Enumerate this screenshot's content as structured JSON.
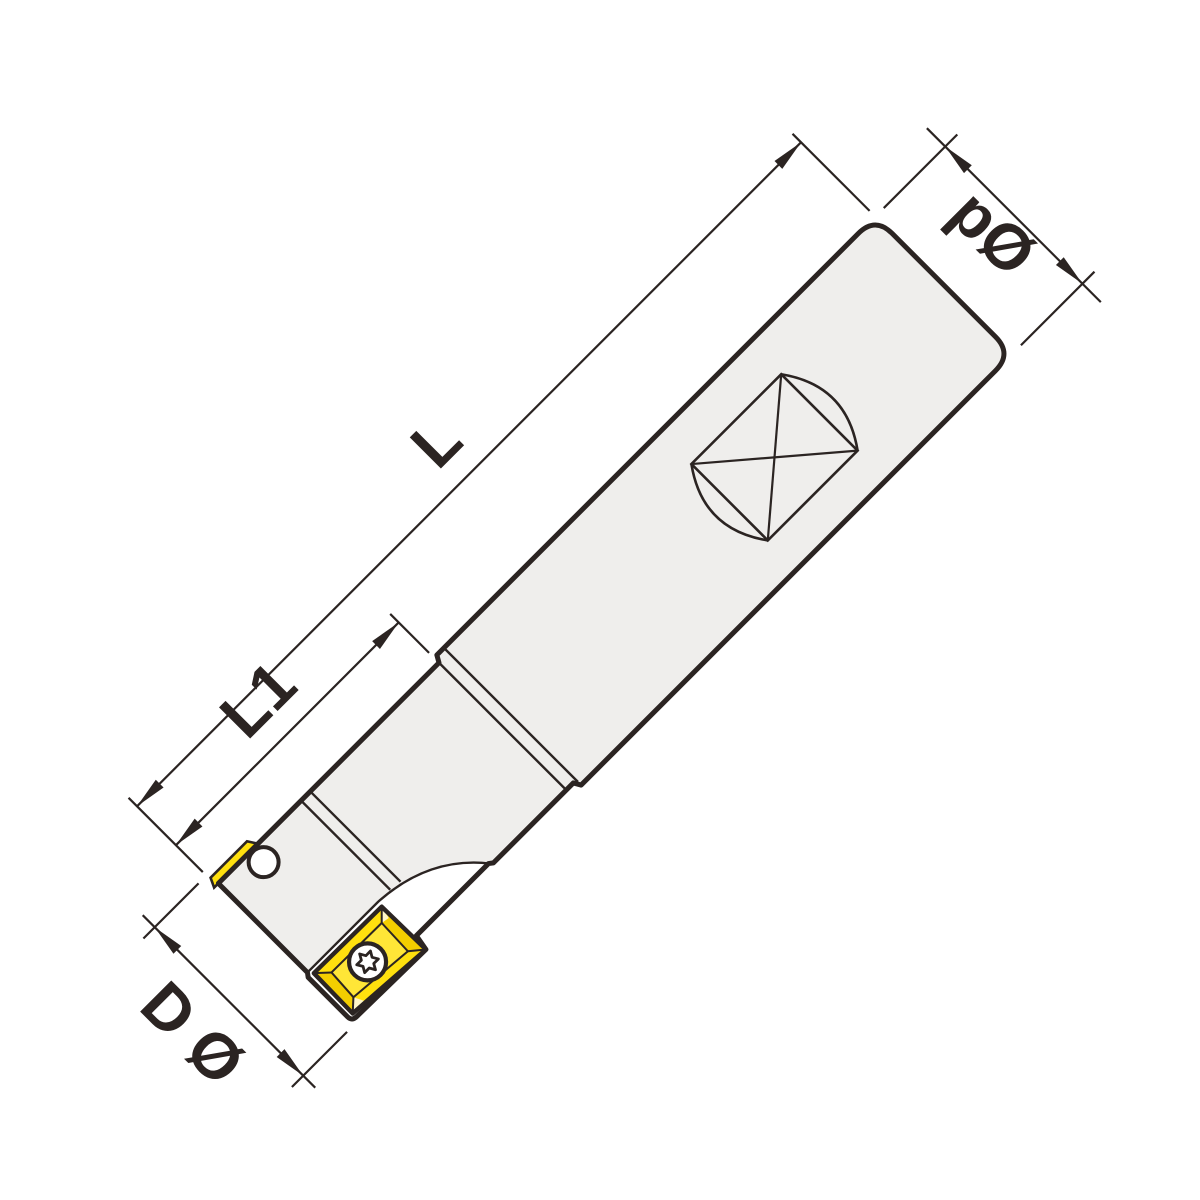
{
  "drawing": {
    "dimensions": {
      "overall_length": {
        "label": "L"
      },
      "head_length": {
        "label": "L1"
      },
      "shank_diameter": {
        "label": "pØ"
      },
      "cutting_diameter": {
        "label": "D Ø"
      }
    },
    "colors": {
      "line": "#2B2422",
      "body_fill": "#EFEEEC",
      "insert_fill": "#FFE00E",
      "insert_bevel": "#F3CE00",
      "insert_plateau": "#FFE637",
      "insert_facet": "#FFF6C8",
      "background": "#FFFFFF"
    }
  }
}
